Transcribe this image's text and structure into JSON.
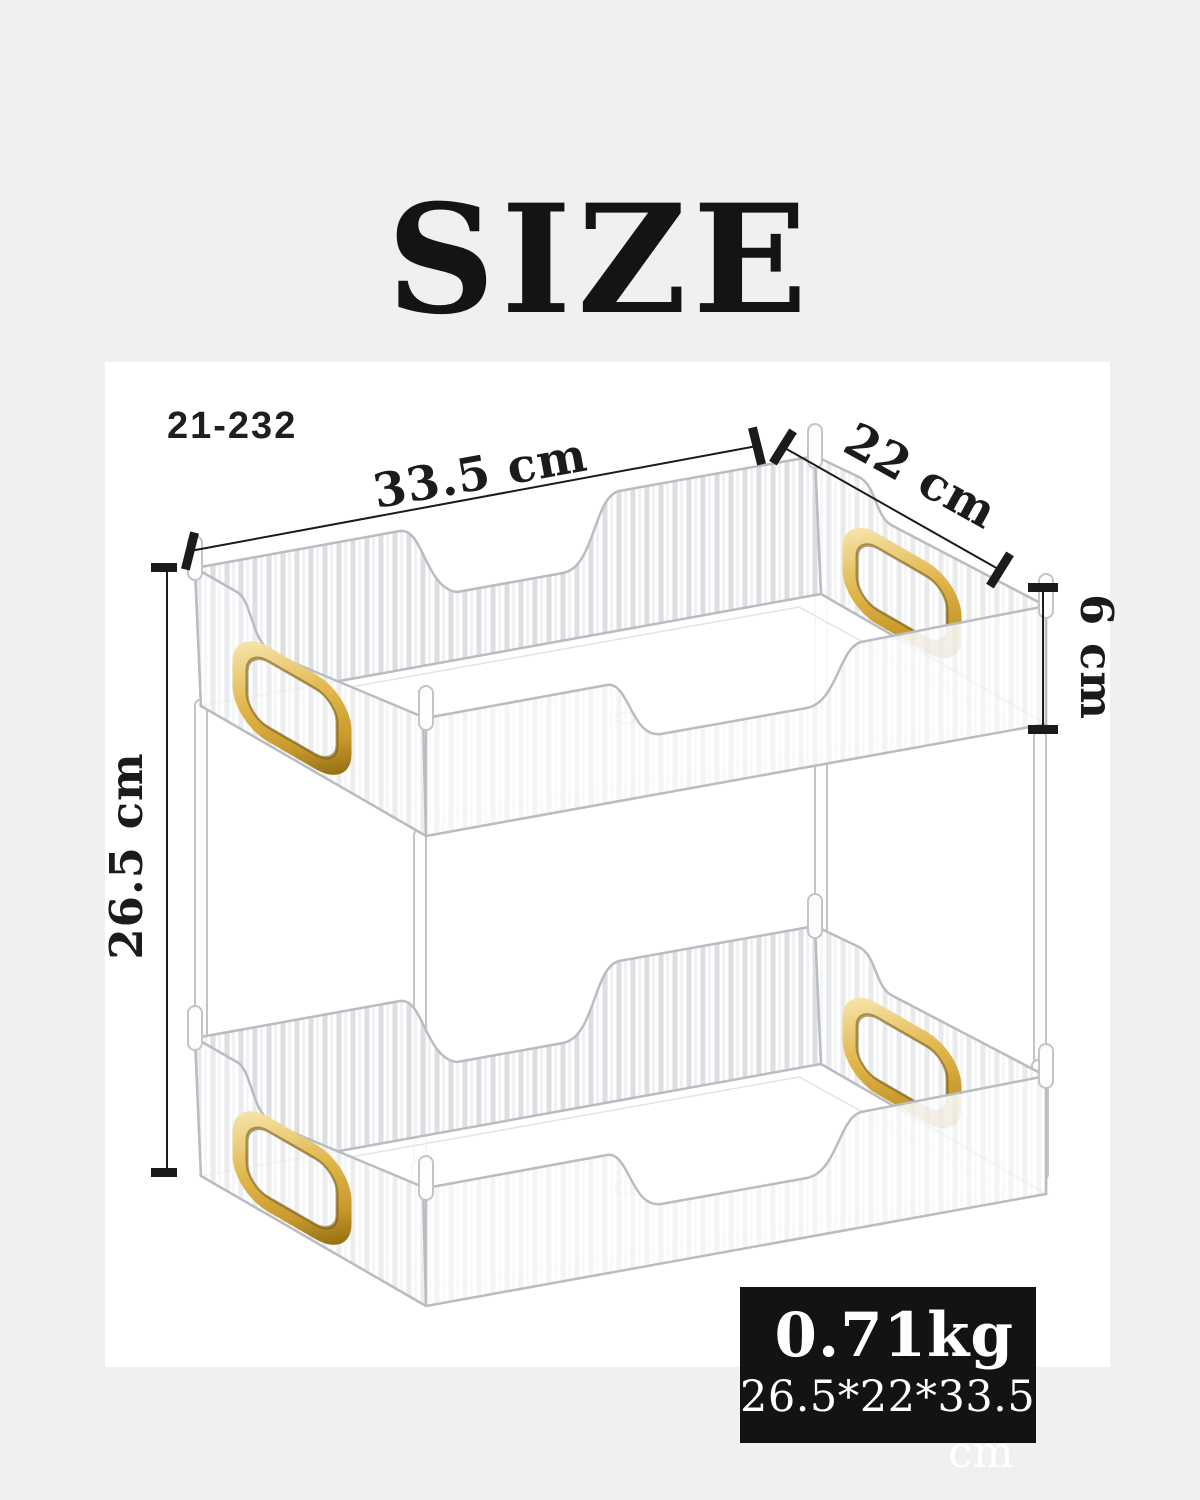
{
  "title": "SIZE",
  "model_number": "21-232",
  "dimensions": {
    "length": "33.5 cm",
    "depth": "22 cm",
    "tier_height": "6 cm",
    "total_height": "26.5 cm"
  },
  "spec_box": {
    "weight": "0.71kg",
    "overall_size": "26.5*22*33.5 cm"
  },
  "product": {
    "type": "two-tier clear ribbed storage organizer with gold handles",
    "tiers": 2
  },
  "colors": {
    "background": "#f1f0ee",
    "panel": "#ffffff",
    "ink": "#1b1b1b",
    "spec_box_bg": "#151312",
    "spec_box_text": "#ffffff",
    "gold_accent": "#dcaf4e",
    "product_outline": "#b9bdc1"
  }
}
